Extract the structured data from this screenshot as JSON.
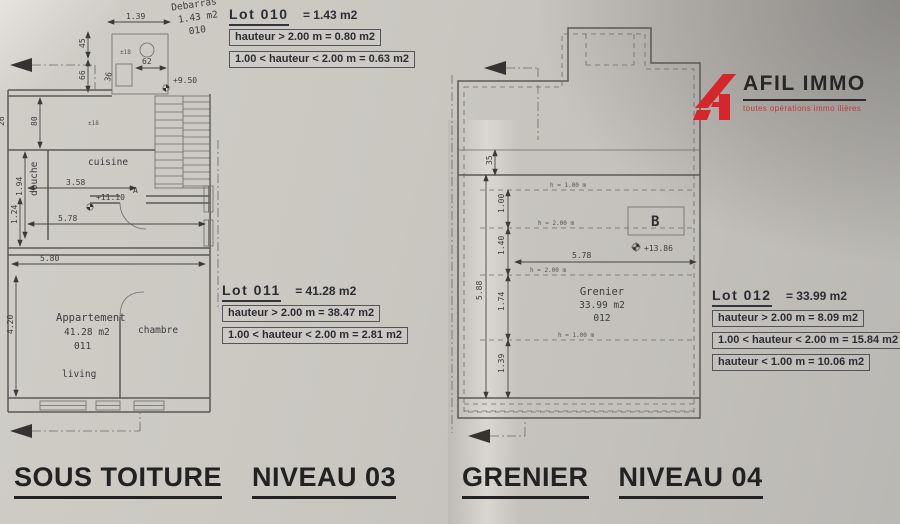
{
  "logo": {
    "brand": "AFIL IMMO",
    "tagline": "toutes opérations immo ilières",
    "red": "#d5262b"
  },
  "titles": {
    "left": {
      "main": "SOUS TOITURE",
      "level": "NIVEAU 03"
    },
    "right": {
      "main": "GRENIER",
      "level": "NIVEAU 04"
    }
  },
  "lots": {
    "lot010": {
      "name": "Lot 010",
      "total": "= 1.43 m2",
      "rows": [
        "hauteur > 2.00 m =  0.80 m2",
        "1.00 < hauteur < 2.00 m =  0.63 m2"
      ]
    },
    "lot011": {
      "name": "Lot 011",
      "total": "= 41.28 m2",
      "rows": [
        "hauteur > 2.00 m =  38.47 m2",
        "1.00 < hauteur < 2.00 m =  2.81 m2"
      ]
    },
    "lot012": {
      "name": "Lot 012",
      "total": "= 33.99 m2",
      "rows": [
        "hauteur > 2.00 m =  8.09 m2",
        "1.00 < hauteur < 2.00 m =  15.84 m2",
        "hauteur < 1.00 m =  10.06 m2"
      ]
    }
  },
  "plan_left": {
    "rooms": {
      "debarras_name": "Debarras",
      "debarras_area": "1.43 m2",
      "debarras_lot": "010",
      "cuisine": "cuisine",
      "douche": "douche",
      "apt_name": "Appartement",
      "apt_area": "41.28 m2",
      "apt_lot": "011",
      "chambre": "chambre",
      "living": "living"
    },
    "levels": {
      "stair": "+9.50",
      "floor": "+11.10"
    },
    "door": "A",
    "notes": {
      "step1": "±18",
      "step2": "±18"
    },
    "dims": {
      "top_w": "1.39",
      "v45": "45",
      "v66": "66",
      "w62": "62",
      "a36": "36",
      "v80": "80",
      "v26": "26",
      "v194": "1.94",
      "w358": "3.58",
      "v124": "1.24",
      "w578": "5.78",
      "w580": "5.80",
      "v420": "4.20"
    }
  },
  "plan_right": {
    "room": {
      "name": "Grenier",
      "area": "33.99 m2",
      "lot": "012"
    },
    "level": "+13.86",
    "section": "B",
    "dims": {
      "v35": "35",
      "v100": "1.00",
      "v140": "1.40",
      "v174": "1.74",
      "v139": "1.39",
      "v588": "5.88",
      "w578": "5.78"
    },
    "heights": {
      "l1": "h = 1.00 m",
      "l2": "h = 2.00 m",
      "l3": "h = 2.00 m",
      "l4": "h = 1.00 m"
    }
  }
}
